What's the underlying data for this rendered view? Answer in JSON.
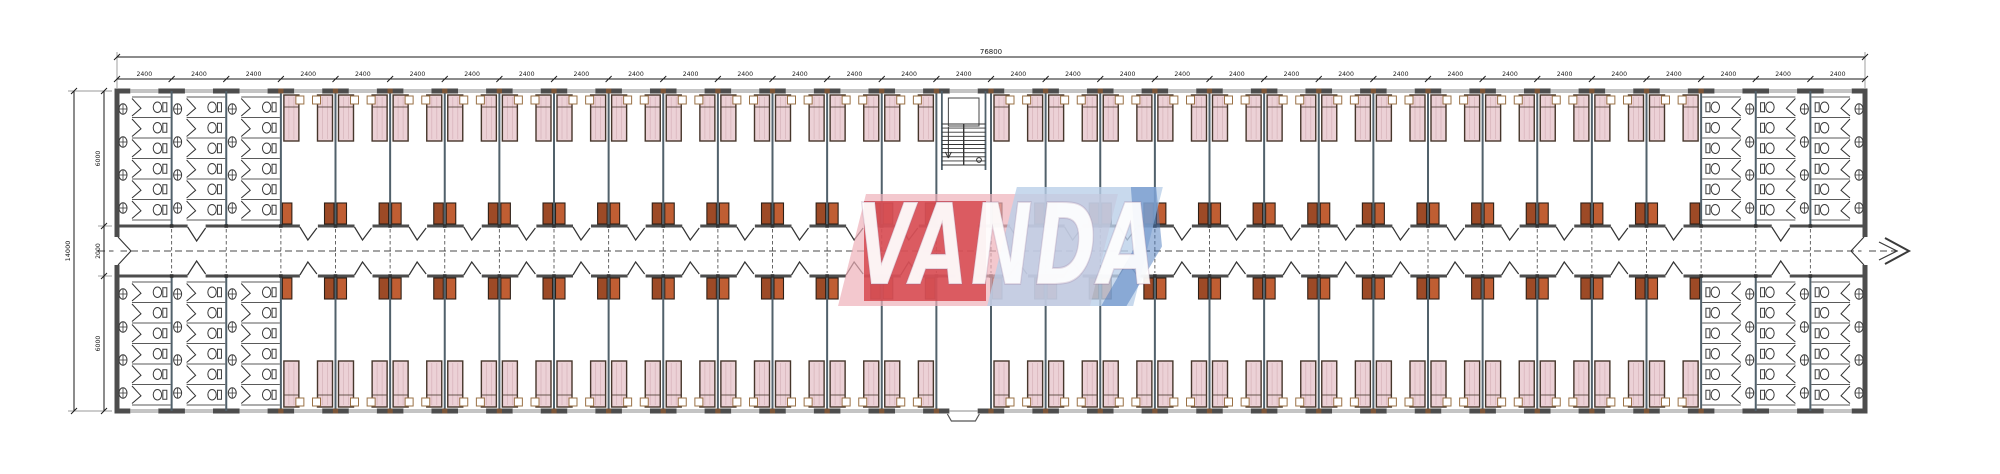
{
  "watermark": {
    "text": "VANDA",
    "pink": "#eeb0b9",
    "red": "#d33c42",
    "light_blue": "#bad0e9",
    "blue": "#4a79bd",
    "letter_color": "#ffffff"
  },
  "dimensions": {
    "top_total": "76800",
    "bay_label": "2400",
    "left_total": "14000",
    "left_segments": [
      "6000",
      "2000",
      "6000"
    ]
  },
  "plan": {
    "bay_count": 32,
    "bay_width_mm": 2400,
    "toilet_bays_each_end": 3,
    "stair_bay_index": 15,
    "entrance_bay_index": 15,
    "stalls_per_toilet_bay": 6,
    "basins_per_column": 4,
    "beds_per_room": 2,
    "colors": {
      "wall": "#4d4d4d",
      "partition": "#51616b",
      "bed_fill": "#ecd1d6",
      "bed_stroke": "#46362b",
      "bed_hatch": "#d9b6bd",
      "pillow_fill": "#ffffff",
      "pillow_stroke": "#9a7146",
      "wardrobe_dark": "#9d4a26",
      "wardrobe_light": "#c05e33",
      "wardrobe_stroke": "#2e2017",
      "fixture": "#3a3a3a",
      "door": "#333333",
      "dim": "#1a1a1a",
      "column": "#7d5638",
      "centerline": "#4a4a4a",
      "window": "#8a8a8a"
    }
  }
}
